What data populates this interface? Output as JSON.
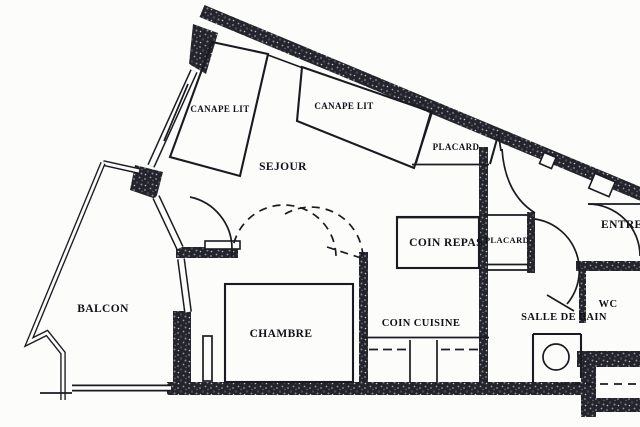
{
  "plan": {
    "type": "apartment-floor-plan",
    "labels": {
      "sejour": "SEJOUR",
      "balcon": "BALCON",
      "chambre": "CHAMBRE",
      "coin_cuisine": "COIN CUISINE",
      "coin_repas": "COIN REPAS",
      "salle_de_bain": "SALLE DE BAIN",
      "wc": "WC",
      "entree": "ENTREE",
      "placard_1": "PLACARD",
      "placard_2": "PLACARD",
      "canape_lit_1": "CANAPE LIT",
      "canape_lit_2": "CANAPE LIT"
    },
    "colors": {
      "ink": "#1a1a22",
      "paper": "#fcfcfa",
      "wall_texture_base": "#24242c"
    }
  }
}
